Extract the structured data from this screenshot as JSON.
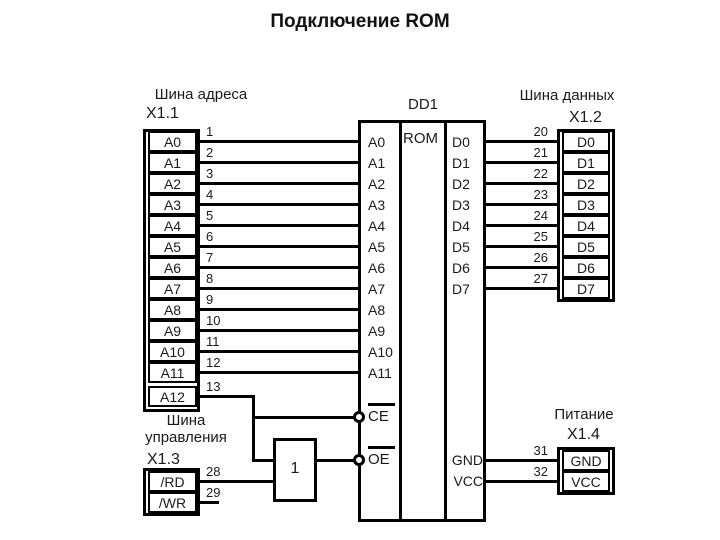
{
  "title": "Подключение ROM",
  "colors": {
    "line": "#000000",
    "text": "#1a1a1a",
    "background": "#ffffff"
  },
  "address_bus": {
    "label": "Шина адреса",
    "connector": "X1.1",
    "signals": [
      {
        "name": "A0",
        "pin": "1"
      },
      {
        "name": "A1",
        "pin": "2"
      },
      {
        "name": "A2",
        "pin": "3"
      },
      {
        "name": "A3",
        "pin": "4"
      },
      {
        "name": "A4",
        "pin": "5"
      },
      {
        "name": "A5",
        "pin": "6"
      },
      {
        "name": "A6",
        "pin": "7"
      },
      {
        "name": "A7",
        "pin": "8"
      },
      {
        "name": "A8",
        "pin": "9"
      },
      {
        "name": "A9",
        "pin": "10"
      },
      {
        "name": "A10",
        "pin": "11"
      },
      {
        "name": "A11",
        "pin": "12"
      },
      {
        "name": "A12",
        "pin": "13"
      }
    ]
  },
  "data_bus": {
    "label": "Шина данных",
    "connector": "X1.2",
    "signals": [
      {
        "name": "D0",
        "pin": "20"
      },
      {
        "name": "D1",
        "pin": "21"
      },
      {
        "name": "D2",
        "pin": "22"
      },
      {
        "name": "D3",
        "pin": "23"
      },
      {
        "name": "D4",
        "pin": "24"
      },
      {
        "name": "D5",
        "pin": "25"
      },
      {
        "name": "D6",
        "pin": "26"
      },
      {
        "name": "D7",
        "pin": "27"
      }
    ]
  },
  "control_bus": {
    "label": "Шина управления",
    "connector": "X1.3",
    "signals": [
      {
        "name": "/RD",
        "pin": "28"
      },
      {
        "name": "/WR",
        "pin": "29"
      }
    ]
  },
  "power": {
    "label": "Питание",
    "connector": "X1.4",
    "signals": [
      {
        "name": "GND",
        "pin": "31"
      },
      {
        "name": "VCC",
        "pin": "32"
      }
    ]
  },
  "chip": {
    "designator": "DD1",
    "type": "ROM",
    "address_pins": [
      "A0",
      "A1",
      "A2",
      "A3",
      "A4",
      "A5",
      "A6",
      "A7",
      "A8",
      "A9",
      "A10",
      "A11"
    ],
    "control_pins": [
      "CE",
      "OE"
    ],
    "data_pins": [
      "D0",
      "D1",
      "D2",
      "D3",
      "D4",
      "D5",
      "D6",
      "D7"
    ],
    "power_pins": [
      "GND",
      "VCC"
    ]
  },
  "gate": {
    "label": "1"
  }
}
